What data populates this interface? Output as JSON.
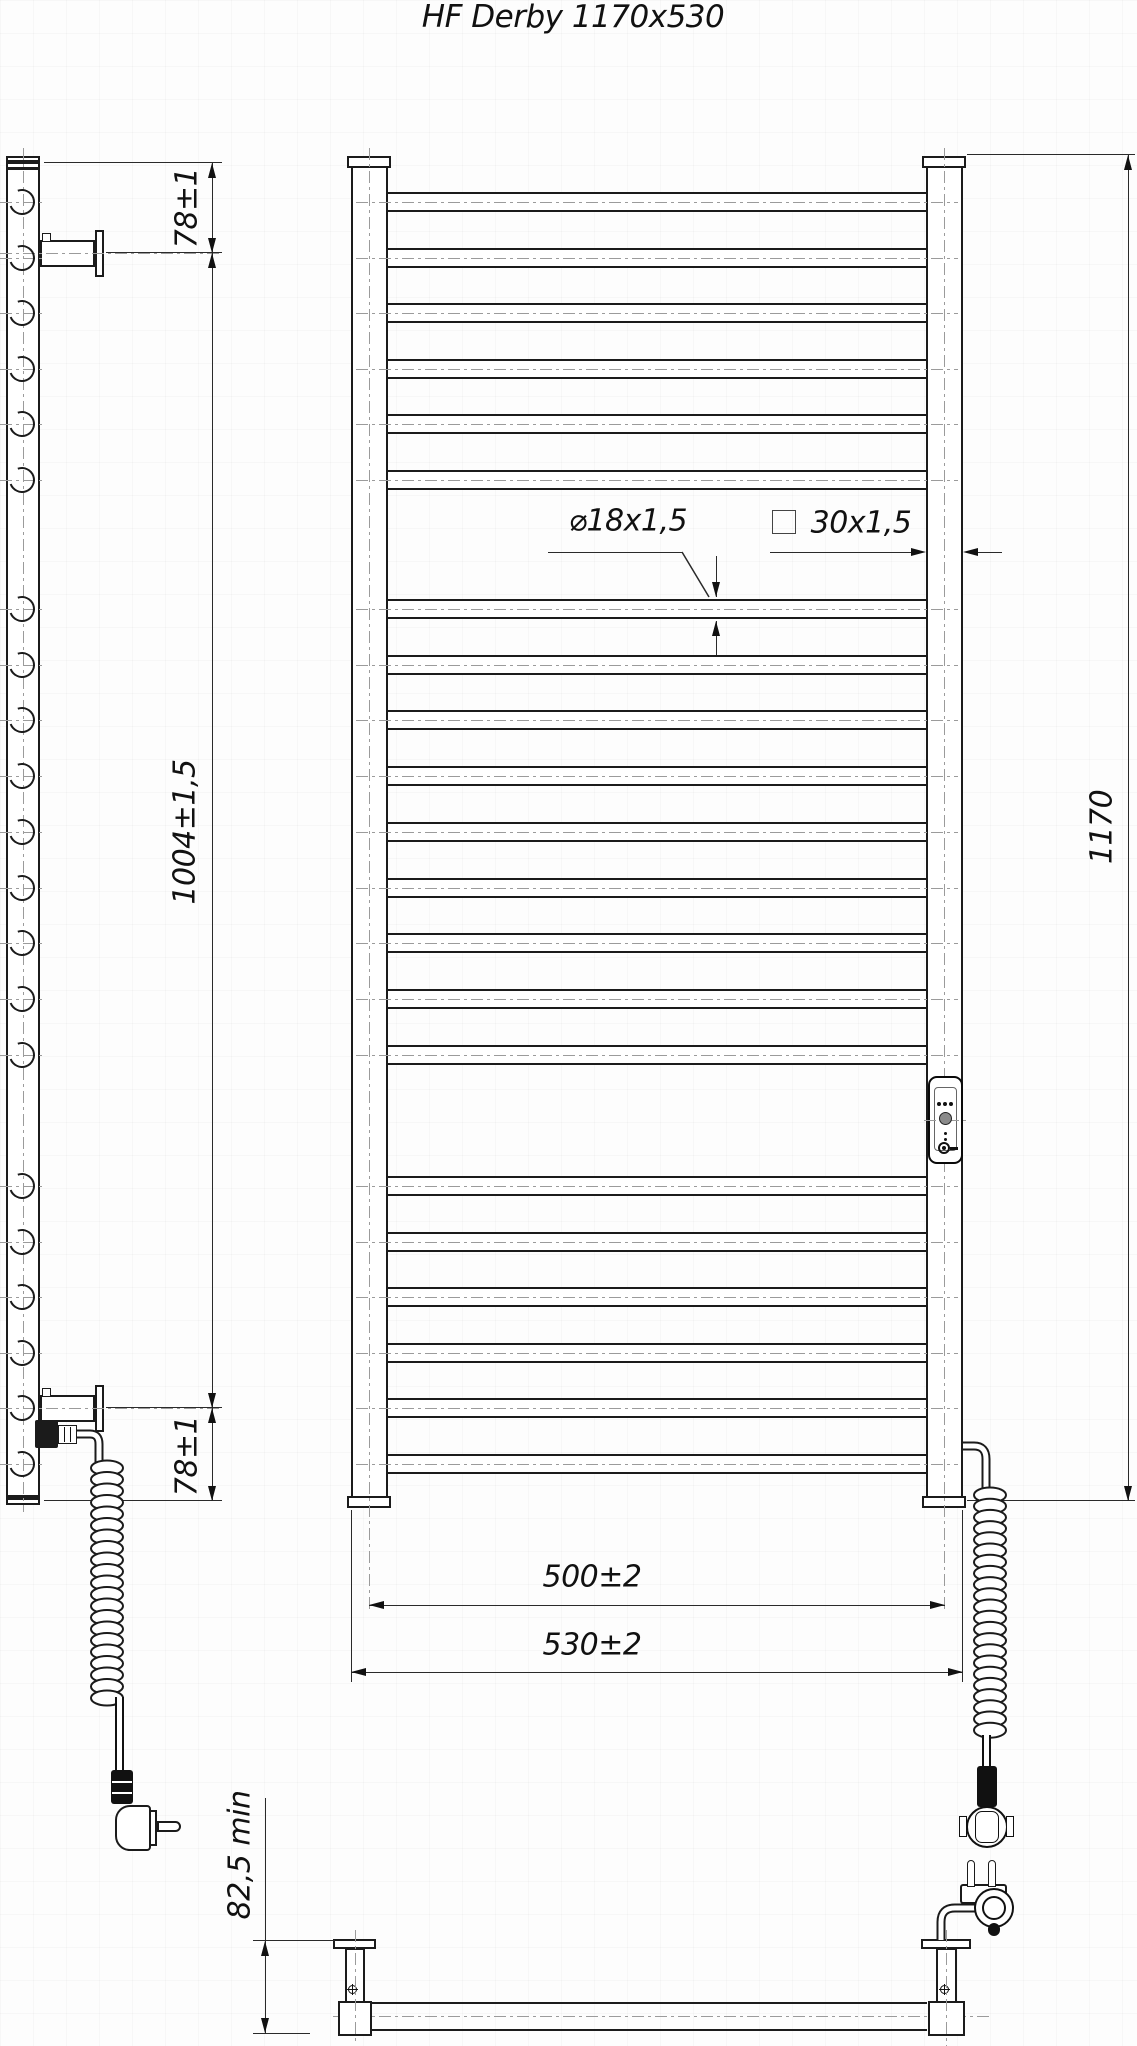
{
  "title": "HF Derby 1170x530",
  "dimensions": {
    "side_top_offset": "78±1",
    "side_mount_span": "1004±1,5",
    "side_bottom_offset": "78±1",
    "bar_spec": "⌀18x1,5",
    "post_spec": "30x1,5",
    "total_height": "1170",
    "center_width": "500±2",
    "overall_width": "530±2",
    "wall_distance": "82,5 min"
  },
  "structure": {
    "bar_count": 21,
    "bar_centers_y": [
      202,
      258,
      313,
      369,
      424,
      480,
      609,
      665,
      720,
      776,
      832,
      888,
      943,
      999,
      1055,
      1186,
      1242,
      1297,
      1353,
      1408,
      1464
    ],
    "coil_left": {
      "cx": 107,
      "y_start": 1468,
      "loops": 21,
      "step": 11.5,
      "rx": 16,
      "ry": 7.5
    },
    "coil_right": {
      "cx": 990,
      "y_start": 1495,
      "loops": 22,
      "step": 11.2,
      "rx": 16,
      "ry": 7.5
    }
  },
  "colors": {
    "line": "#1b1b1b",
    "thin": "#2a2a2a",
    "centerline": "#9b9b9b",
    "fill": "#ffffff"
  }
}
